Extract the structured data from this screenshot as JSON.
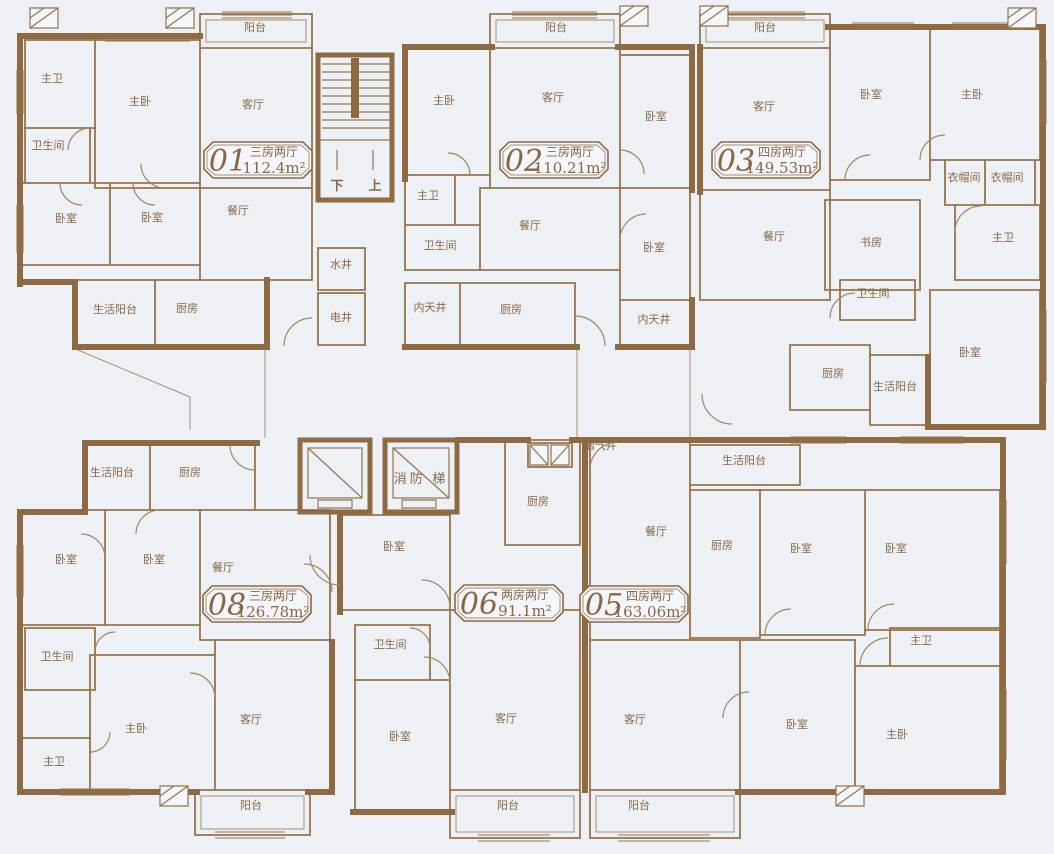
{
  "colors": {
    "background": "#edf1f6",
    "wall": "#8d6a41",
    "line": "#96744a",
    "text": "#8a6743"
  },
  "units": [
    {
      "number": "01",
      "layout": "三房两厅",
      "area": "112.4m²"
    },
    {
      "number": "02",
      "layout": "三房两厅",
      "area": "110.21m²"
    },
    {
      "number": "03",
      "layout": "四房两厅",
      "area": "149.53m²"
    },
    {
      "number": "08",
      "layout": "三房两厅",
      "area": "126.78m²"
    },
    {
      "number": "06",
      "layout": "两房两厅",
      "area": "91.1m²"
    },
    {
      "number": "05",
      "layout": "四房两厅",
      "area": "163.06m²"
    }
  ],
  "stair": {
    "down": "下",
    "up": "上"
  },
  "core": {
    "fire_elevator": "消防  梯"
  },
  "rooms": [
    {
      "label": "阳台",
      "x": 255,
      "y": 31
    },
    {
      "label": "主卫",
      "x": 52,
      "y": 82
    },
    {
      "label": "主卧",
      "x": 140,
      "y": 105
    },
    {
      "label": "客厅",
      "x": 253,
      "y": 108
    },
    {
      "label": "卫生间",
      "x": 48,
      "y": 149
    },
    {
      "label": "卧室",
      "x": 66,
      "y": 222
    },
    {
      "label": "卧室",
      "x": 152,
      "y": 221
    },
    {
      "label": "餐厅",
      "x": 238,
      "y": 214
    },
    {
      "label": "生活阳台",
      "x": 115,
      "y": 313
    },
    {
      "label": "厨房",
      "x": 187,
      "y": 312
    },
    {
      "label": "水井",
      "x": 341,
      "y": 268
    },
    {
      "label": "电井",
      "x": 341,
      "y": 321
    },
    {
      "label": "阳台",
      "x": 556,
      "y": 31
    },
    {
      "label": "主卧",
      "x": 444,
      "y": 104
    },
    {
      "label": "客厅",
      "x": 553,
      "y": 101
    },
    {
      "label": "卧室",
      "x": 656,
      "y": 120
    },
    {
      "label": "主卫",
      "x": 428,
      "y": 199
    },
    {
      "label": "卫生间",
      "x": 440,
      "y": 249
    },
    {
      "label": "餐厅",
      "x": 530,
      "y": 229
    },
    {
      "label": "卧室",
      "x": 654,
      "y": 251
    },
    {
      "label": "内天井",
      "x": 430,
      "y": 311
    },
    {
      "label": "厨房",
      "x": 511,
      "y": 313
    },
    {
      "label": "内天井",
      "x": 654,
      "y": 323
    },
    {
      "label": "阳台",
      "x": 765,
      "y": 31
    },
    {
      "label": "客厅",
      "x": 764,
      "y": 110
    },
    {
      "label": "卧室",
      "x": 871,
      "y": 98
    },
    {
      "label": "主卧",
      "x": 972,
      "y": 98
    },
    {
      "label": "衣帽间",
      "x": 964,
      "y": 181
    },
    {
      "label": "衣帽间",
      "x": 1007,
      "y": 181
    },
    {
      "label": "餐厅",
      "x": 774,
      "y": 240
    },
    {
      "label": "书房",
      "x": 871,
      "y": 246
    },
    {
      "label": "主卫",
      "x": 1003,
      "y": 241
    },
    {
      "label": "卫生间",
      "x": 873,
      "y": 297
    },
    {
      "label": "厨房",
      "x": 833,
      "y": 377
    },
    {
      "label": "生活阳台",
      "x": 895,
      "y": 390
    },
    {
      "label": "卧室",
      "x": 970,
      "y": 356
    },
    {
      "label": "烟气井",
      "x": 600,
      "y": 449
    },
    {
      "label": "生活阳台",
      "x": 112,
      "y": 476
    },
    {
      "label": "厨房",
      "x": 190,
      "y": 476
    },
    {
      "label": "卧室",
      "x": 66,
      "y": 563
    },
    {
      "label": "卧室",
      "x": 154,
      "y": 563
    },
    {
      "label": "餐厅",
      "x": 223,
      "y": 571
    },
    {
      "label": "卫生间",
      "x": 57,
      "y": 660
    },
    {
      "label": "主卫",
      "x": 54,
      "y": 765
    },
    {
      "label": "主卧",
      "x": 136,
      "y": 732
    },
    {
      "label": "客厅",
      "x": 251,
      "y": 723
    },
    {
      "label": "阳台",
      "x": 251,
      "y": 809
    },
    {
      "label": "厨房",
      "x": 538,
      "y": 505
    },
    {
      "label": "卧室",
      "x": 394,
      "y": 550
    },
    {
      "label": "卫生间",
      "x": 390,
      "y": 648
    },
    {
      "label": "卧室",
      "x": 400,
      "y": 740
    },
    {
      "label": "客厅",
      "x": 506,
      "y": 722
    },
    {
      "label": "阳台",
      "x": 508,
      "y": 809
    },
    {
      "label": "生活阳台",
      "x": 744,
      "y": 464
    },
    {
      "label": "餐厅",
      "x": 656,
      "y": 535
    },
    {
      "label": "厨房",
      "x": 722,
      "y": 549
    },
    {
      "label": "卧室",
      "x": 801,
      "y": 552
    },
    {
      "label": "卧室",
      "x": 896,
      "y": 552
    },
    {
      "label": "主卫",
      "x": 921,
      "y": 644
    },
    {
      "label": "客厅",
      "x": 635,
      "y": 723
    },
    {
      "label": "卧室",
      "x": 797,
      "y": 728
    },
    {
      "label": "主卧",
      "x": 897,
      "y": 738
    },
    {
      "label": "阳台",
      "x": 639,
      "y": 809
    }
  ]
}
